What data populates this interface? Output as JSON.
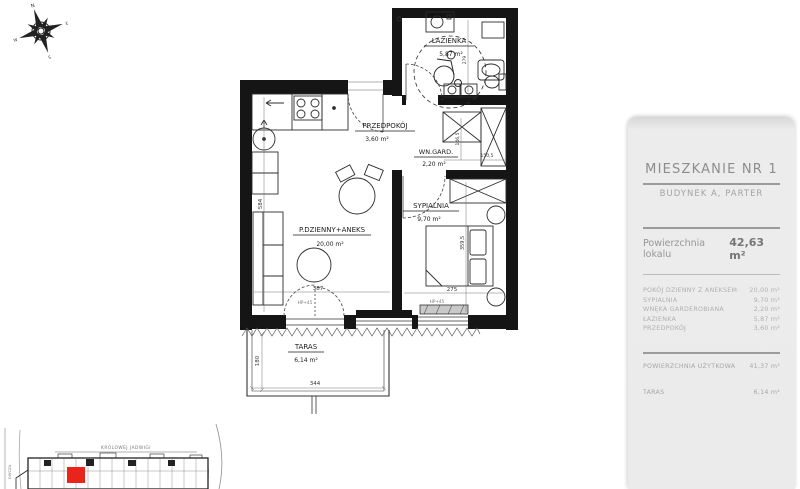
{
  "panel": {
    "title": "MIESZKANIE NR 1",
    "subtitle": "BUDYNEK A, PARTER",
    "area_label": "Powierzchnia lokalu",
    "area_value": "42,63 m²",
    "rooms": [
      {
        "name": "POKÓJ DZIENNY Z ANEKSEM",
        "area": "20,00 m²"
      },
      {
        "name": "SYPIALNIA",
        "area": "9,70 m²"
      },
      {
        "name": "WNĘKA GARDEROBIANA",
        "area": "2,20 m²"
      },
      {
        "name": "ŁAZIENKA",
        "area": "5,87 m²"
      },
      {
        "name": "PRZEDPOKÓJ",
        "area": "3,60 m²"
      }
    ],
    "usable_label": "POWIERZCHNIA UŻYTKOWA",
    "usable_value": "41,37 m²",
    "terrace_label": "TARAS",
    "terrace_value": "6,14 m²"
  },
  "plan": {
    "rooms": [
      {
        "name": "ŁAZIENKA",
        "area": "5,87 m²"
      },
      {
        "name": "PRZEDPOKÓJ",
        "area": "3,60 m²"
      },
      {
        "name": "WN.GARD.",
        "area": "2,20 m²"
      },
      {
        "name": "SYPIALNIA",
        "area": "9,70 m²"
      },
      {
        "name": "P.DZIENNY+ANEKS",
        "area": "20,00 m²"
      },
      {
        "name": "TARAS",
        "area": "6,14 m²"
      }
    ],
    "dimensions": {
      "living_width": "387",
      "living_depth": "584",
      "bedroom_width": "275",
      "bedroom_depth": "359,5",
      "wardrobe_width": "150,5",
      "wardrobe_depth": "146,5",
      "bathroom_depth": "279",
      "terrace_width": "344",
      "terrace_depth": "180",
      "window_sill_living": "HP+45",
      "window_sill_bedroom": "HP+45"
    }
  },
  "site_plan": {
    "street_top": "KRÓLOWEJ JADWIGI",
    "street_left": "OWCZA",
    "street_right": "WIGA"
  },
  "compass": {
    "north": "N",
    "east": "E",
    "south": "S",
    "west": "W"
  },
  "colors": {
    "highlight_unit": "#e8241d",
    "panel_bg": "#ebebeb"
  }
}
